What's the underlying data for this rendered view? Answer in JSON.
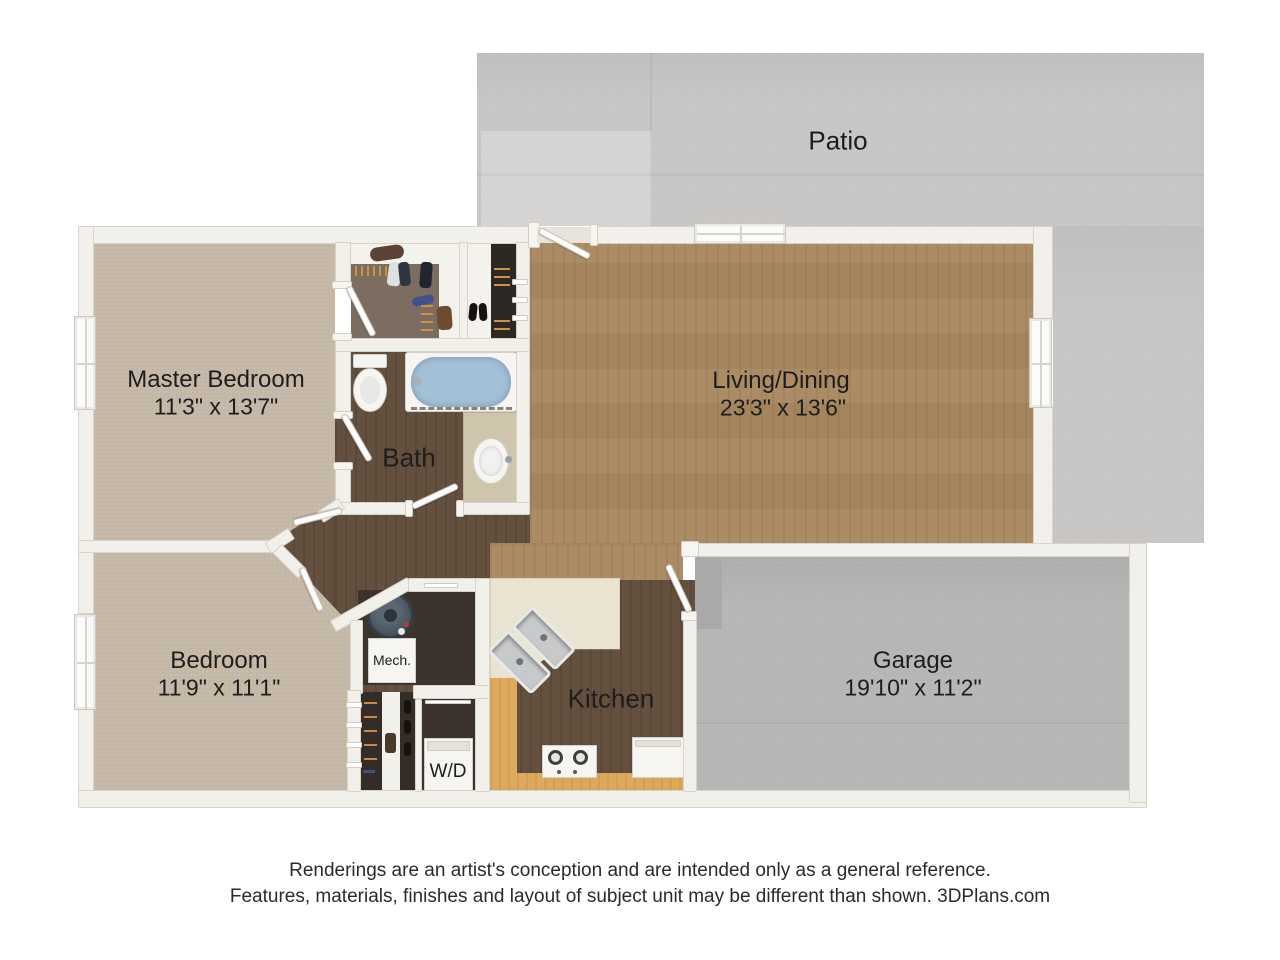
{
  "rooms": {
    "patio": {
      "name": "Patio"
    },
    "master": {
      "name": "Master Bedroom",
      "dims": "11'3\" x 13'7\""
    },
    "living": {
      "name": "Living/Dining",
      "dims": "23'3\" x 13'6\""
    },
    "bath": {
      "name": "Bath"
    },
    "bedroom": {
      "name": "Bedroom",
      "dims": "11'9\" x 11'1\""
    },
    "kitchen": {
      "name": "Kitchen"
    },
    "garage": {
      "name": "Garage",
      "dims": "19'10\" x 11'2\""
    },
    "mech": {
      "name": "Mech."
    },
    "laundry": {
      "name": "W/D"
    }
  },
  "footer": {
    "line1": "Renderings are an artist's conception and are intended only as a general reference.",
    "line2": "Features, materials, finishes and layout of subject unit may be different than shown. 3DPlans.com"
  },
  "palette": {
    "wall": "#f2f0ea",
    "carpet": "#c4b7a5",
    "wood_living": "#a8885f",
    "wood_dark": "#64503f",
    "patio_concrete": "#c7c6c4",
    "garage_concrete": "#b6b7b4",
    "counter": "#e9e4d2",
    "cabinet_wood": "#dca95d",
    "tub_water": "#a3c1d6"
  }
}
